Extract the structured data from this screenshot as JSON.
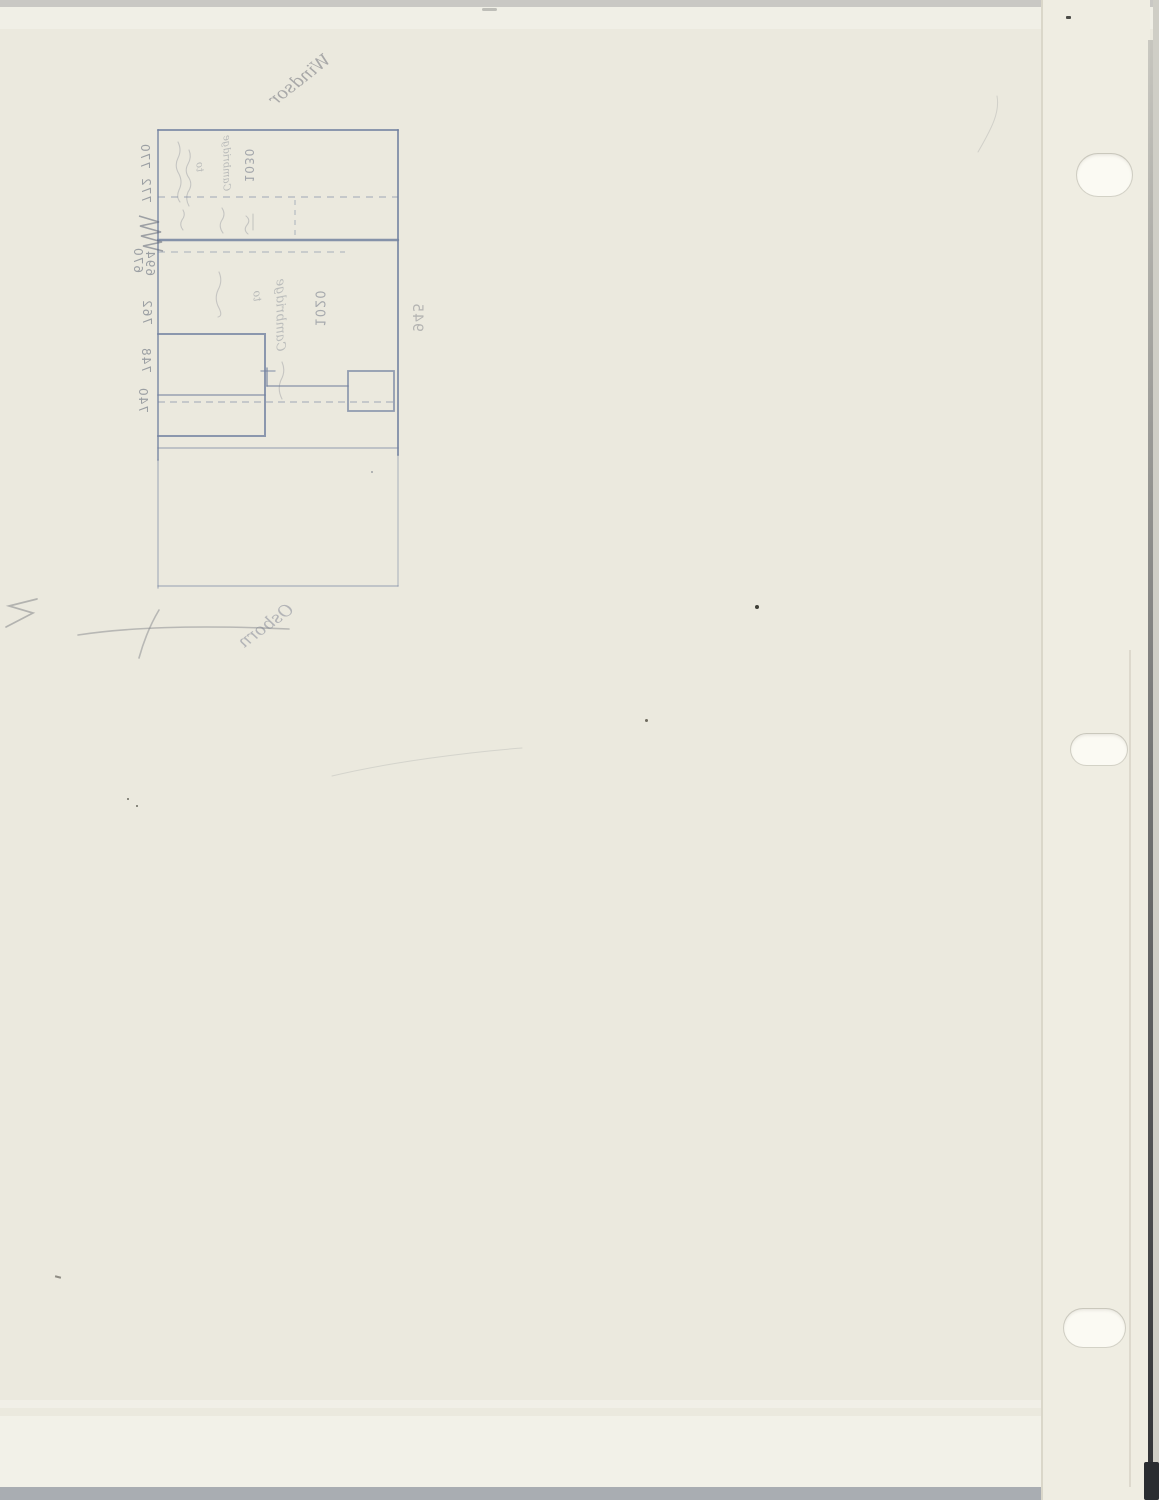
{
  "colors": {
    "paper": "#ebe9de",
    "ink": "#7382a0",
    "pencil": "#84878f",
    "striptop": "#c9c8c4",
    "stripbottom": "#a9adb2",
    "hole": "#fbfaf3"
  },
  "sketch": {
    "street_name_top": "Windsor",
    "street_name_bottom": "Osborn",
    "block_word_upper": "Cambridge",
    "block_word_mid": "Cambridge",
    "word_to_upper": "to",
    "word_to_mid": "to",
    "address_upper": "1030",
    "address_mid": "1020",
    "address_side": "945",
    "lot_numbers": [
      "770",
      "772",
      "670",
      "694",
      "762",
      "748",
      "740"
    ]
  }
}
